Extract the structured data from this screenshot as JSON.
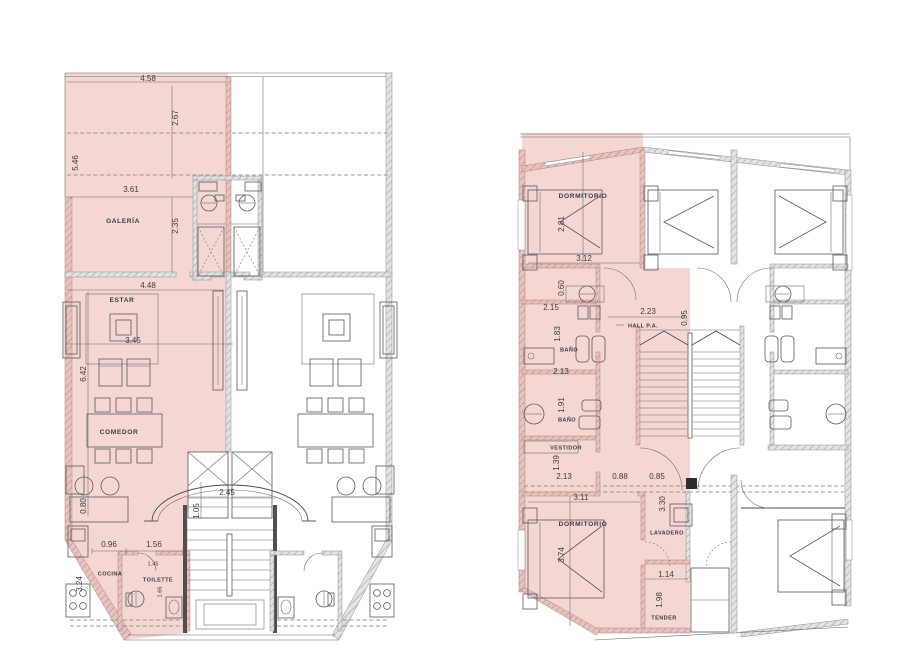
{
  "colors": {
    "highlight": "#f4d7d3",
    "highlight_wall": "#c9948f",
    "wall_gray": "#e0e0e0",
    "line": "#4c4c4c"
  },
  "left_plan": {
    "rooms": {
      "galeria": "GALERÍA",
      "estar": "ESTAR",
      "comedor": "COMEDOR",
      "cocina": "COCINA",
      "toilette": "TOILETTE"
    },
    "dims": {
      "width_top": "4.58",
      "depth_deck": "2.67",
      "height_side": "5.46",
      "galeria_width": "3.61",
      "galeria_depth": "2.35",
      "estar_width": "4.48",
      "estar_rug": "3.45",
      "height_mid": "6.42",
      "entry_width": "2.45",
      "entry_depth": "1.05",
      "counter_depth": "0.80",
      "cocina_a": "0.96",
      "cocina_b": "1.56",
      "cocina_side": "3.24",
      "toilette_width": "1.45",
      "toilette_depth": "1.66"
    }
  },
  "right_plan": {
    "rooms": {
      "dormitorio_1": "DORMITORIO",
      "hall": "HALL P.A.",
      "banio_1": "BAÑO",
      "banio_2": "BAÑO",
      "vestidor": "VESTIDOR",
      "dormitorio_2": "DORMITORIO",
      "lavadero": "LAVADERO",
      "tender": "TENDER"
    },
    "dims": {
      "dorm1_depth": "2.81",
      "dorm1_width": "3.12",
      "paso": "0.60",
      "banio1_width": "2.15",
      "banio1_depth": "1.83",
      "hall_width": "2.23",
      "hall_depth": "0.95",
      "banio2_width": "2.13",
      "banio2_depth": "1.91",
      "vestidor_depth": "1.39",
      "vestidor_width": "2.13",
      "puerta_a": "0.88",
      "puerta_b": "0.85",
      "dorm2_width": "3.11",
      "lavadero_depth": "3.30",
      "dorm2_depth": "3.74",
      "tender_width": "1.14",
      "tender_depth": "1.98"
    }
  }
}
